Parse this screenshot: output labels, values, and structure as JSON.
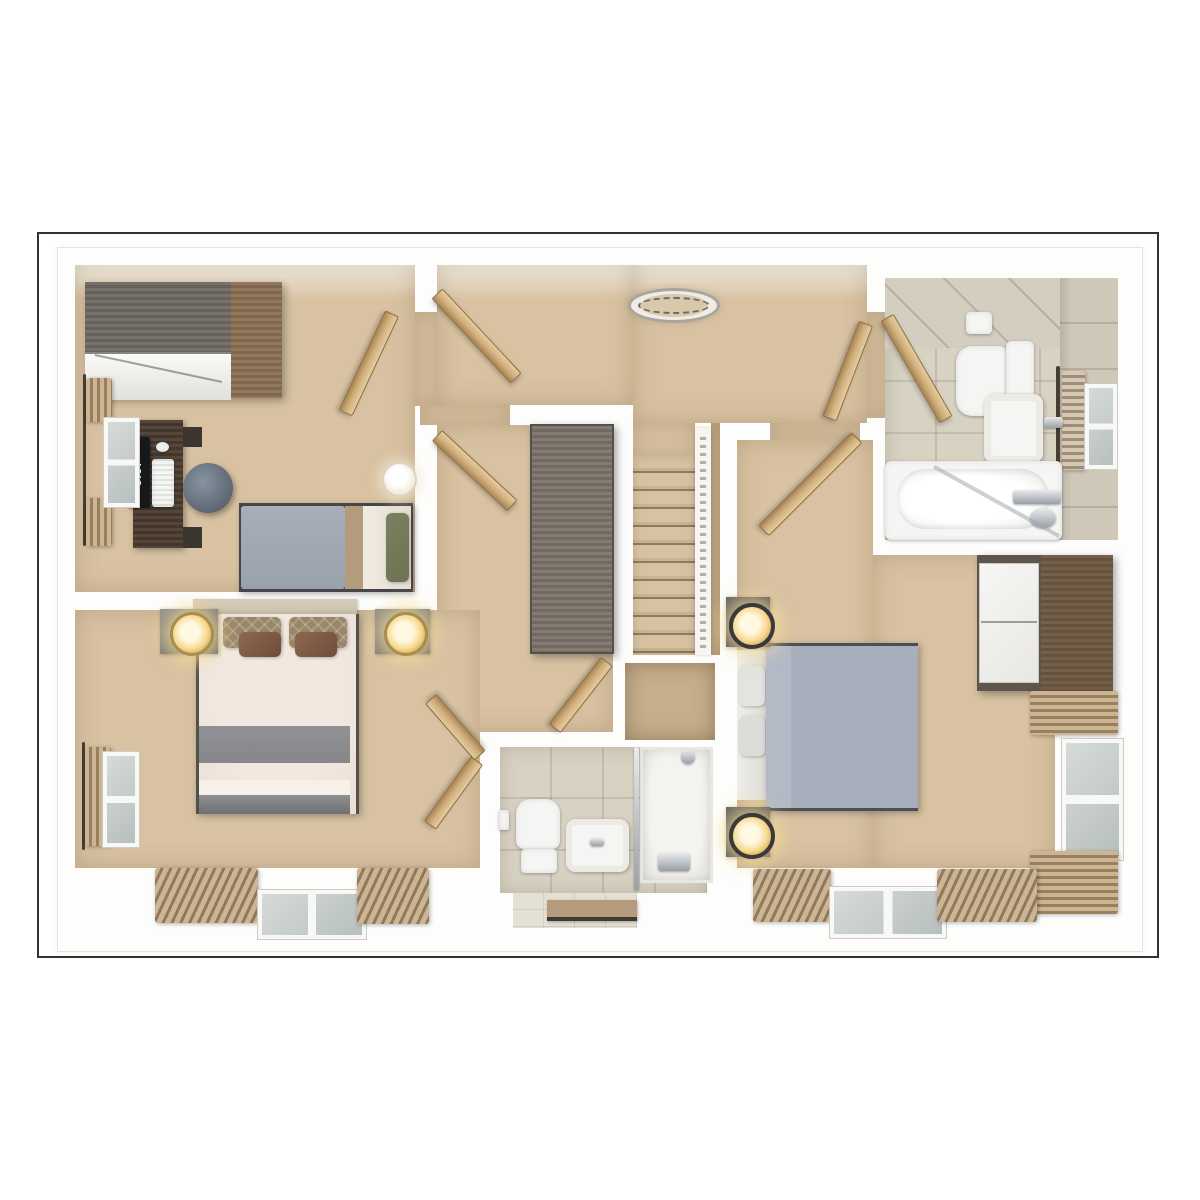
{
  "scene": {
    "kind": "3d-floor-plan-top-down-render",
    "rooms": [
      "bedroom-top-left",
      "landing-with-stairs",
      "bathroom-top-right",
      "master-bedroom-with-dressing-area",
      "bathroom-center",
      "bedroom-right"
    ]
  },
  "monitor": {
    "time": "8:37"
  },
  "palette": {
    "frame": "#35322e",
    "carpet": "#d8c2a2",
    "carpet_dark": "#c6ae8c",
    "tile": "#d8d2c3",
    "tile_light": "#e5e0d4",
    "wood_door": "#cfae7e",
    "wood_dark": "#4a3a2e",
    "wood_grayblue": "#6e6862",
    "wood_side": "#8a6f52",
    "cabinet_gray": "#7b7268",
    "duvet_gray": "#a7afbc",
    "duvet_single": "#9aa2ad",
    "duvet_master": "#ebdfd5",
    "throw_gray": "#85878b",
    "pillow_green": "#6d7352",
    "blanket_tan": "#b39b7c",
    "lamp": "#f7d98f",
    "lamp_ring": "#3a3a3c",
    "headboard": "#cbc2ae"
  },
  "inventory": {
    "bedroom_top_left": [
      "wardrobe",
      "desk",
      "monitor",
      "keyboard",
      "mouse",
      "stool",
      "single-bed",
      "green-pillow",
      "bedside-lamp",
      "window",
      "curtains",
      "door"
    ],
    "master_bedroom": [
      "double-bed",
      "two-nightstands",
      "two-lamps",
      "dressing-wardrobe",
      "windows",
      "curtains",
      "doors"
    ],
    "bedroom_right": [
      "double-bed",
      "two-nightstands",
      "two-lamps",
      "wardrobe",
      "windows",
      "curtains",
      "door"
    ],
    "bathroom_top_right": [
      "toilet",
      "basin",
      "bathtub",
      "towel",
      "window",
      "door",
      "glass-screen"
    ],
    "bathroom_center": [
      "toilet",
      "basin",
      "shower-enclosure",
      "bath-mat",
      "doors"
    ],
    "landing": [
      "staircase",
      "banister",
      "ceiling-light",
      "airing-cupboard",
      "tall-wardrobe"
    ]
  }
}
